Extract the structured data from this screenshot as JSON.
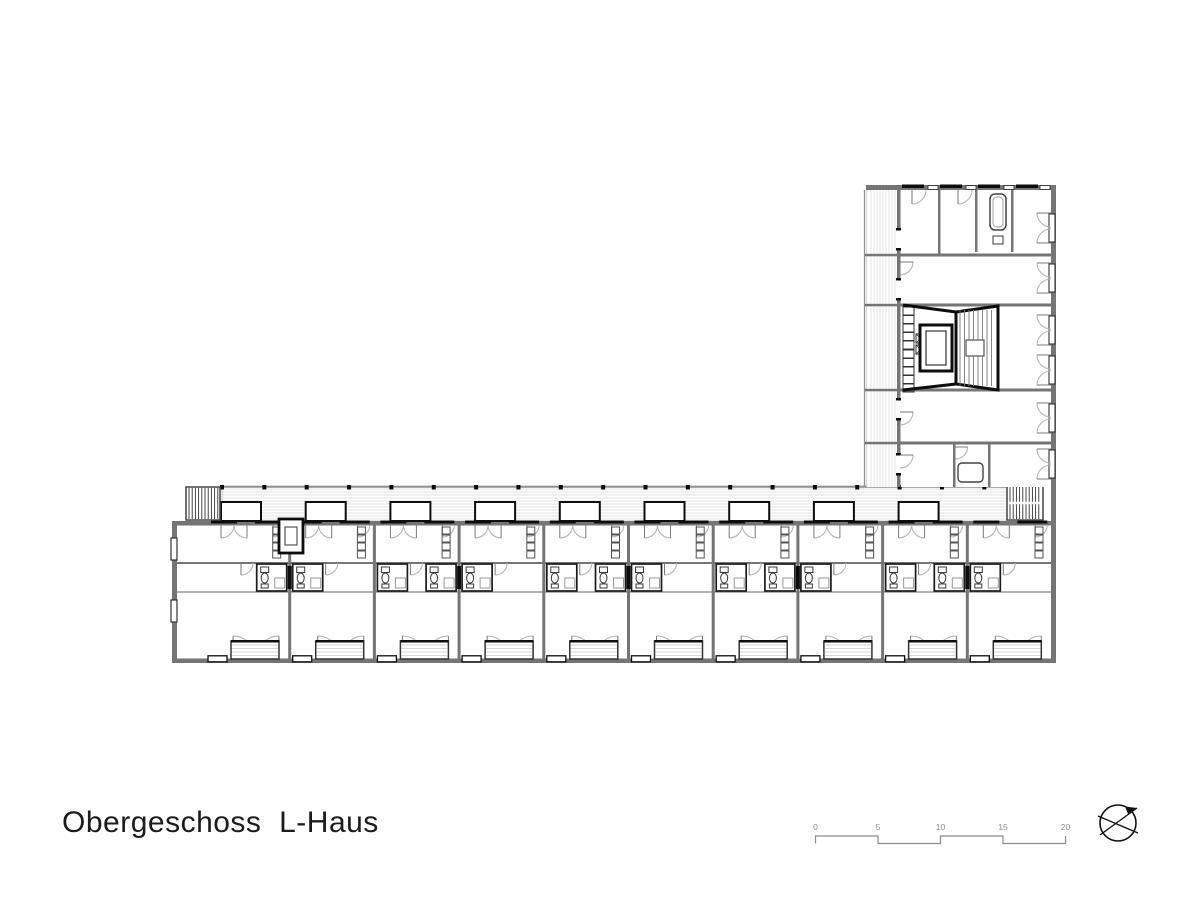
{
  "title": {
    "text": "Obergeschoss  L-Haus"
  },
  "scalebar": {
    "labels": [
      "0",
      "5",
      "10",
      "15",
      "20"
    ],
    "x_start": 815.5,
    "step": 62.5,
    "y_top": 836,
    "y_bot": 843.5,
    "label_y": 830,
    "color": "#8e8e8e",
    "font_size": 8.5
  },
  "north_arrow": {
    "cx": 1118,
    "cy": 823,
    "r": 18,
    "color": "#111111"
  },
  "colors": {
    "wall": "#757575",
    "wall_dark": "#4a4a4a",
    "black": "#0d0d0d",
    "arc": "#b6b6b6",
    "leaf": "#7a7a7a",
    "hatch": "#d9d9d9",
    "rail": "#8f8f8f",
    "fixture": "#3a3a3a",
    "shower": "#9a9a9a",
    "stair_stripe": "#333333",
    "text": "#1c1c1c"
  },
  "plan": {
    "hwing": {
      "x0": 172,
      "x1": 1056,
      "body_top": 521,
      "body_bot": 663,
      "wall": 5,
      "balcony": {
        "x0": 222,
        "x1": 1007,
        "y0": 486,
        "y1": 521
      },
      "units": {
        "n": 10,
        "x0": 205,
        "w": 84.7
      },
      "band_top": 563,
      "band_bot": 592,
      "stair_left": {
        "x": 186,
        "y": 487,
        "w": 34,
        "h": 33
      },
      "stair_right": {
        "x": 1007,
        "y": 486,
        "w": 36,
        "h": 34
      },
      "shaft": {
        "x": 279,
        "y": 519,
        "w": 24,
        "h": 34
      },
      "left_windows_y": [
        538,
        600
      ],
      "pod": {
        "y": 564,
        "h": 27,
        "w": 30
      }
    },
    "vwing": {
      "x0": 866,
      "x1": 1056,
      "y0": 185,
      "y1": 487,
      "wall": 5,
      "balcony": {
        "x0": 867,
        "x1": 897
      },
      "glass_x": 897,
      "floors_y": [
        255,
        305,
        390,
        443
      ],
      "door_gaps_y": [
        230,
        280,
        400,
        455
      ],
      "windows_yc": [
        228,
        278,
        330,
        370,
        418,
        464
      ],
      "core": {
        "y0": 305,
        "y1": 390,
        "lift": {
          "x": 920,
          "y": 325,
          "w": 32,
          "h": 46
        },
        "stair": {
          "x0": 956,
          "x1": 998,
          "ytl": 312,
          "ytr": 306,
          "ybl": 384,
          "ybr": 390
        }
      },
      "top_bath": {
        "wx0": 975,
        "wx1": 1011,
        "tub": [
          990,
          194,
          16,
          36
        ],
        "sink": [
          993,
          236,
          10,
          8
        ]
      },
      "bot_bath": {
        "wx0": 953,
        "wx1": 988,
        "tub": [
          958,
          463,
          25,
          19
        ]
      }
    }
  }
}
